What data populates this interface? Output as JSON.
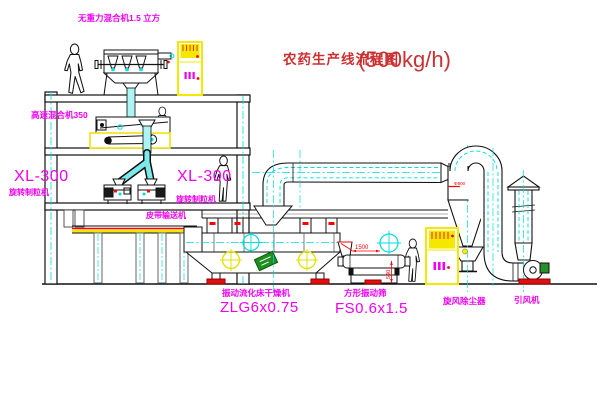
{
  "title": {
    "text": "农药生产线流程图",
    "capacity": "(500kg/h)"
  },
  "labels": {
    "gravity_mixer": "无重力混合机1.5 立方",
    "high_speed_mixer": "高速混合机350",
    "granulator_left_model": "XL-300",
    "granulator_left_name": "旋转制粒机",
    "granulator_mid_model": "XL-300",
    "granulator_mid_name": "旋转制粒机",
    "belt_conveyor": "皮带输送机",
    "fluid_bed_name": "振动流化床干燥机",
    "fluid_bed_model": "ZLG6x0.75",
    "screen_name": "方形振动筛",
    "screen_model": "FS0.6x1.5",
    "cyclone": "旋风除尘器",
    "fan": "引风机"
  },
  "dimensions": {
    "screen_length": "1500",
    "screen_height": "540",
    "cyclone_marking": "Φ800"
  },
  "colors": {
    "label_magenta": "#f000f0",
    "title_red": "#cc3030",
    "dim_red": "#ff0000",
    "line_black": "#111111",
    "accent_cyan": "#00dddd",
    "cabinet_yellow": "#f5e800",
    "machine_green": "#1f8f1f"
  }
}
